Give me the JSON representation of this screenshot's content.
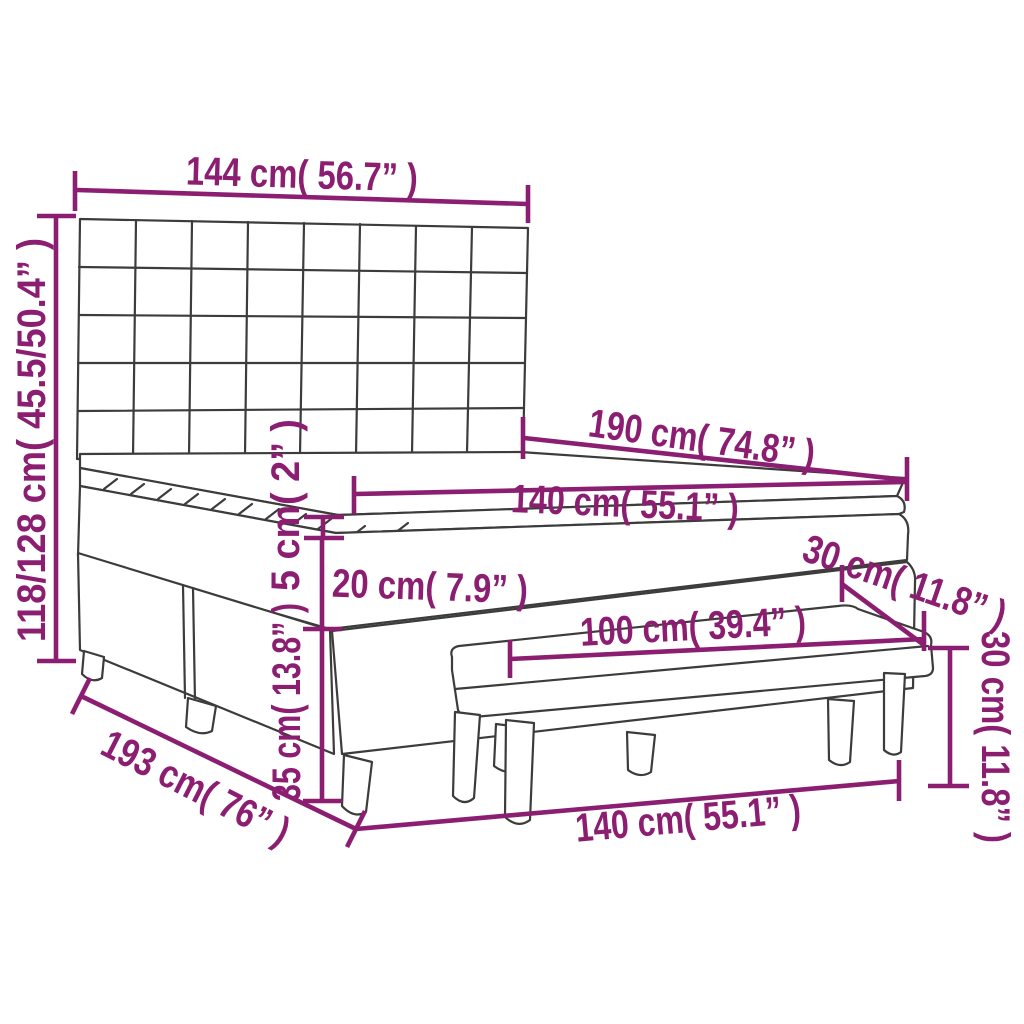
{
  "diagram": {
    "title": "box-spring-bed-with-bench-dimension-diagram",
    "accent_color": "#8c1e72",
    "line_color": "#3c3c3b",
    "background_color": "#ffffff",
    "dimensions": {
      "headboard_width": "144 cm( 56.7” )",
      "total_height": "118/128 cm( 45.5/50.4” )",
      "bed_length": "190 cm( 74.8” )",
      "mattress_width": "140 cm( 55.1” )",
      "topper_height": "5 cm( 2” )",
      "mattress_height": "20 cm( 7.9” )",
      "base_leg_height": "35 cm( 13.8” )",
      "bed_diagonal_length": "193 cm( 76” )",
      "bench_depth": "30 cm( 11.8” )",
      "bench_width": "100 cm( 39.4” )",
      "bench_height": "30 cm( 11.8” )",
      "bed_width": "140 cm( 55.1” )"
    }
  }
}
